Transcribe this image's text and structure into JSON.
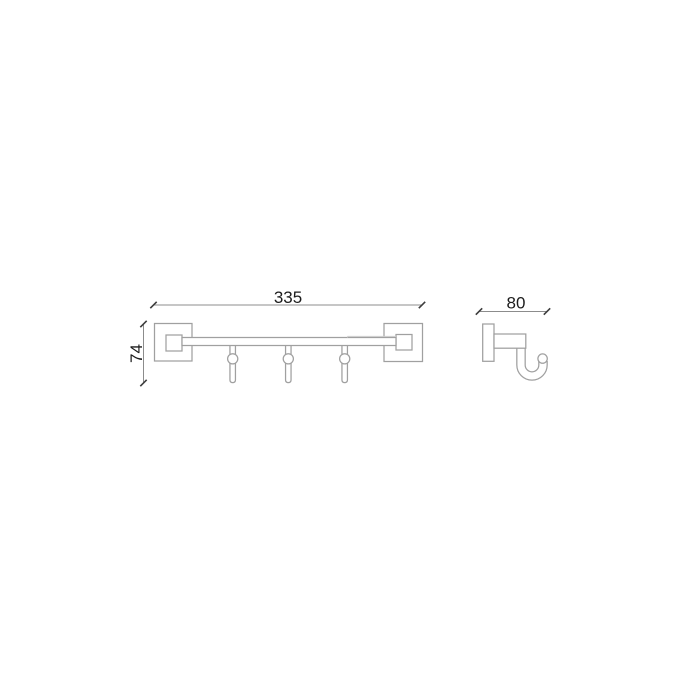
{
  "page": {
    "background_color": "#ffffff"
  },
  "drawing": {
    "front_view": {
      "width_label": "335",
      "height_label": "74",
      "hook_count": 3
    },
    "side_view": {
      "depth_label": "80"
    },
    "colors": {
      "outline": "#a0a0a0",
      "dimension_line": "#8c8c8c",
      "tick": "#3d3d3d",
      "label_text": "#1c1c1c",
      "bar_highlight": "#cdcdcd",
      "background": "#ffffff"
    }
  }
}
